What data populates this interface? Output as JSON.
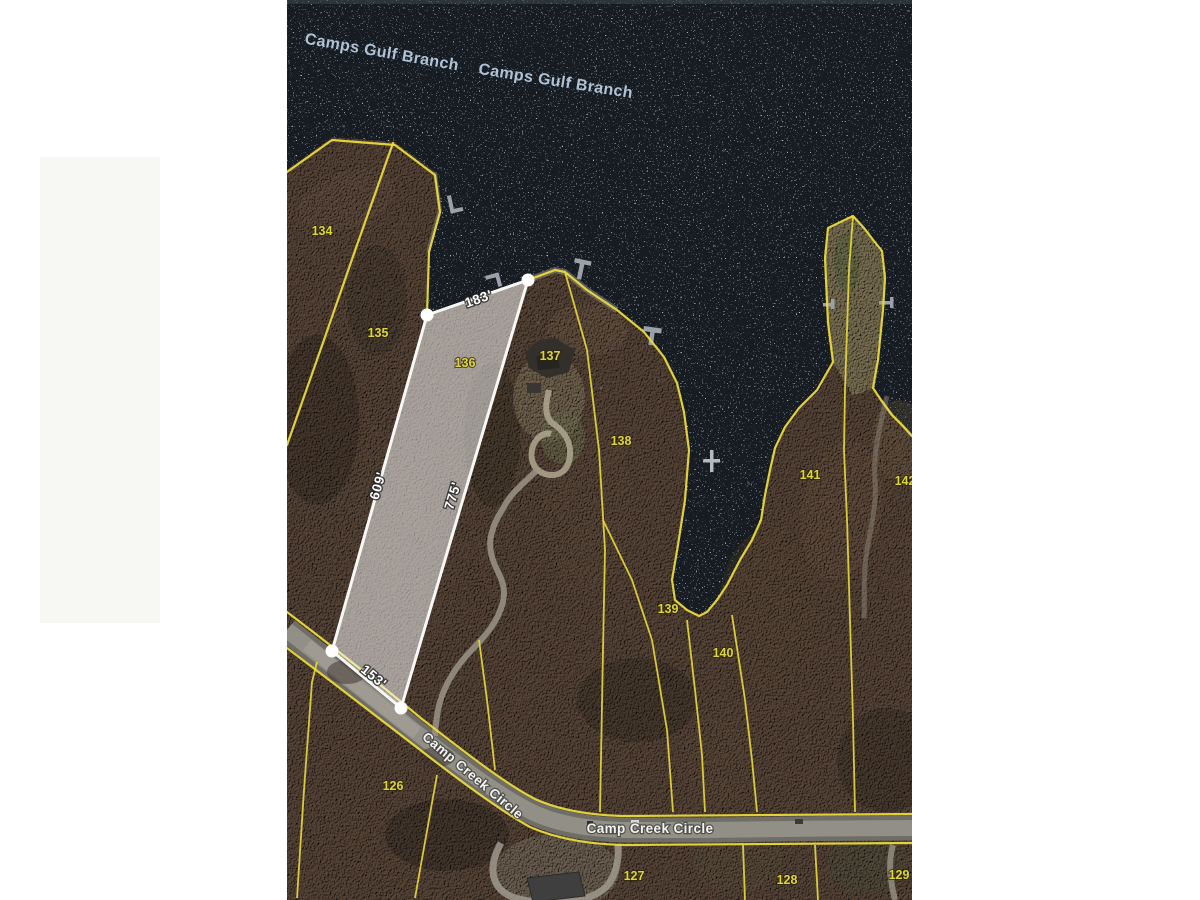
{
  "map": {
    "water_labels": [
      "Camps Gulf Branch",
      "Camps Gulf Branch"
    ],
    "road_labels": [
      "Camp Creek Circle",
      "Camp Creek Circle"
    ],
    "highlight_parcel": {
      "number": "136",
      "dim_top": "183'",
      "dim_left": "609'",
      "dim_right": "775'",
      "dim_bottom": "153'"
    },
    "parcels": [
      {
        "number": "134"
      },
      {
        "number": "135"
      },
      {
        "number": "137"
      },
      {
        "number": "138"
      },
      {
        "number": "139"
      },
      {
        "number": "140"
      },
      {
        "number": "141"
      },
      {
        "number": "142"
      },
      {
        "number": "126"
      },
      {
        "number": "127"
      },
      {
        "number": "128"
      },
      {
        "number": "129"
      }
    ],
    "colors": {
      "water": "#131a22",
      "land": "#4f3f33",
      "boundary_line": "#ead93c",
      "highlight_line": "#ffffff",
      "water_label": "#b0c3d6",
      "parcel_label": "#ddd43e",
      "road_label": "#f2f2ef",
      "road_surface": "#8f8e86"
    }
  }
}
